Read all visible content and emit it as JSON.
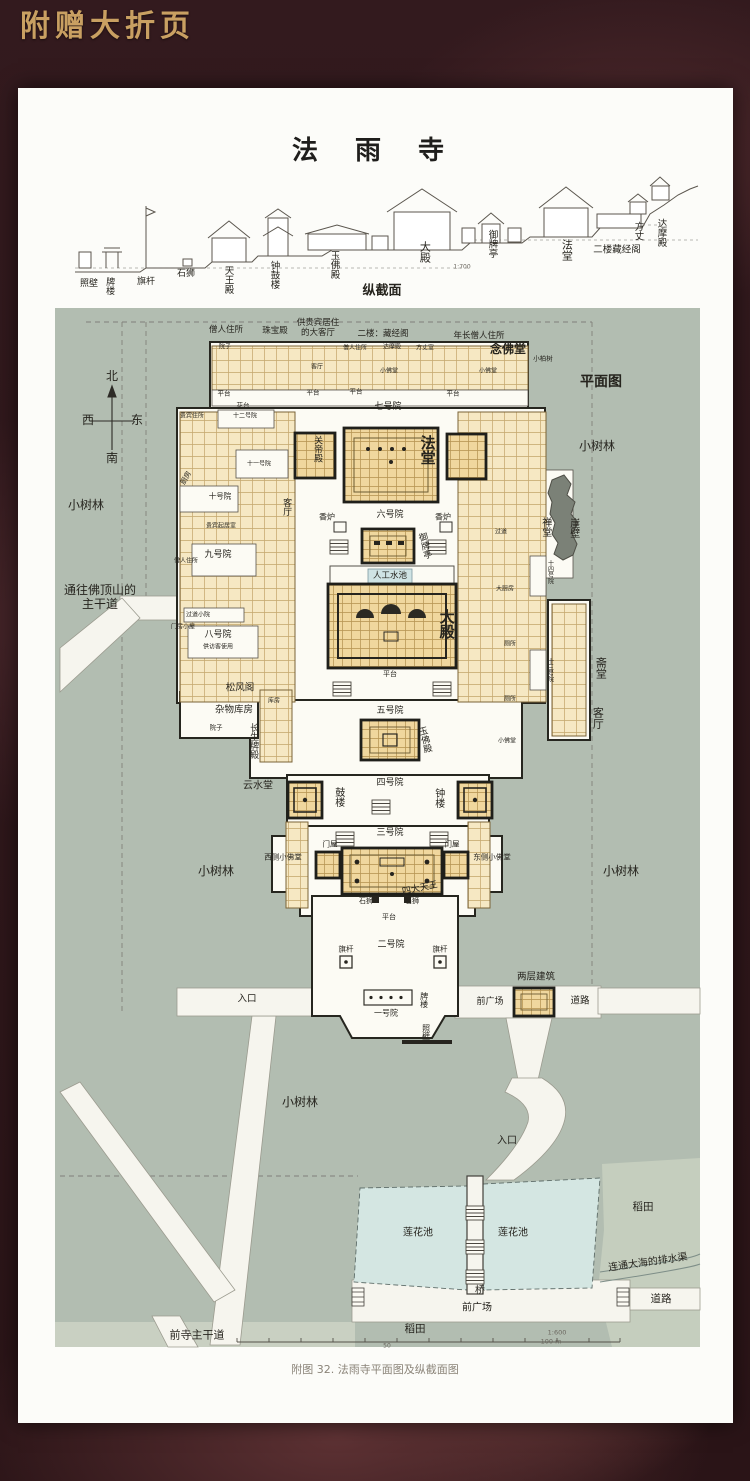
{
  "page": {
    "foldout_title": "附赠大折页",
    "temple_title": "法 雨 寺",
    "caption": "附图 32. 法雨寺平面图及纵截面图"
  },
  "section": {
    "labels": [
      {
        "t": "照壁",
        "x": 89,
        "y": 284,
        "s": 9
      },
      {
        "t": "牌楼",
        "x": 109,
        "y": 286,
        "o": "v",
        "s": 9
      },
      {
        "t": "旗杆",
        "x": 146,
        "y": 282,
        "s": 9
      },
      {
        "t": "石狮",
        "x": 186,
        "y": 274,
        "s": 9
      },
      {
        "t": "天王殿",
        "x": 227,
        "y": 280,
        "o": "v",
        "s": 9.5
      },
      {
        "t": "钟鼓楼",
        "x": 273,
        "y": 275,
        "o": "v",
        "s": 9.5
      },
      {
        "t": "玉佛殿",
        "x": 333,
        "y": 265,
        "o": "v",
        "s": 9.5
      },
      {
        "t": "大殿",
        "x": 424,
        "y": 252,
        "o": "v",
        "s": 11
      },
      {
        "t": "御牌亭",
        "x": 491,
        "y": 244,
        "o": "v",
        "s": 9.5
      },
      {
        "t": "法堂",
        "x": 566,
        "y": 250,
        "o": "v",
        "s": 11
      },
      {
        "t": "二楼藏经阁",
        "x": 617,
        "y": 251,
        "s": 9.5
      },
      {
        "t": "方丈",
        "x": 637,
        "y": 231,
        "o": "v",
        "s": 9.5
      },
      {
        "t": "达摩殿",
        "x": 660,
        "y": 233,
        "o": "v",
        "s": 9.5
      },
      {
        "t": "纵截面",
        "x": 382,
        "y": 292,
        "s": 13,
        "b": 1
      },
      {
        "t": "1:700",
        "x": 462,
        "y": 268,
        "s": 6,
        "c": "#6b675f"
      }
    ]
  },
  "plan": {
    "labels": [
      {
        "t": "平面图",
        "x": 601,
        "y": 382,
        "s": 14,
        "b": 1
      },
      {
        "t": "北",
        "x": 112,
        "y": 377,
        "s": 12
      },
      {
        "t": "西",
        "x": 88,
        "y": 421,
        "s": 12
      },
      {
        "t": "东",
        "x": 137,
        "y": 421,
        "s": 12
      },
      {
        "t": "南",
        "x": 112,
        "y": 459,
        "s": 12
      },
      {
        "t": "小树林",
        "x": 86,
        "y": 506,
        "s": 12
      },
      {
        "t": "小树林",
        "x": 597,
        "y": 447,
        "s": 12
      },
      {
        "t": "小树林",
        "x": 216,
        "y": 872,
        "s": 12
      },
      {
        "t": "小树林",
        "x": 621,
        "y": 872,
        "s": 12
      },
      {
        "t": "小树林",
        "x": 300,
        "y": 1103,
        "s": 12
      },
      {
        "t": "通往佛顶山的\n主干道",
        "x": 100,
        "y": 598,
        "s": 12
      },
      {
        "t": "僧人住所",
        "x": 226,
        "y": 331,
        "s": 8.5
      },
      {
        "t": "珠宝殿",
        "x": 275,
        "y": 332,
        "s": 8.5
      },
      {
        "t": "供贵宾居住\n的大客厅",
        "x": 318,
        "y": 329,
        "s": 8.5
      },
      {
        "t": "二楼：藏经阁",
        "x": 383,
        "y": 335,
        "s": 8.5
      },
      {
        "t": "年长僧人住所",
        "x": 479,
        "y": 337,
        "s": 8.5
      },
      {
        "t": "念佛堂",
        "x": 508,
        "y": 350,
        "s": 12,
        "b": 1
      },
      {
        "t": "小柏树",
        "x": 543,
        "y": 359,
        "s": 6.5
      },
      {
        "t": "院子",
        "x": 225,
        "y": 348,
        "s": 6
      },
      {
        "t": "客厅",
        "x": 317,
        "y": 368,
        "s": 6
      },
      {
        "t": "僧人住所",
        "x": 355,
        "y": 349,
        "s": 6
      },
      {
        "t": "达摩殿",
        "x": 392,
        "y": 348,
        "s": 6
      },
      {
        "t": "方丈室",
        "x": 425,
        "y": 349,
        "s": 6
      },
      {
        "t": "小佛堂",
        "x": 389,
        "y": 372,
        "s": 6
      },
      {
        "t": "小佛堂",
        "x": 488,
        "y": 372,
        "s": 6
      },
      {
        "t": "平台",
        "x": 224,
        "y": 394,
        "s": 6.5
      },
      {
        "t": "平台",
        "x": 313,
        "y": 393,
        "s": 6.5
      },
      {
        "t": "平台",
        "x": 356,
        "y": 392,
        "s": 6.5
      },
      {
        "t": "平台",
        "x": 453,
        "y": 394,
        "s": 6.5
      },
      {
        "t": "花台",
        "x": 243,
        "y": 406,
        "s": 6.5
      },
      {
        "t": "七号院",
        "x": 388,
        "y": 407,
        "s": 9
      },
      {
        "t": "贵宾住所",
        "x": 192,
        "y": 417,
        "s": 6
      },
      {
        "t": "十二号院",
        "x": 245,
        "y": 417,
        "s": 6
      },
      {
        "t": "十一号院",
        "x": 259,
        "y": 465,
        "s": 6
      },
      {
        "t": "十号院",
        "x": 220,
        "y": 497,
        "s": 7.5
      },
      {
        "t": "贵宾起居室",
        "x": 221,
        "y": 527,
        "s": 6
      },
      {
        "t": "厨房",
        "x": 186,
        "y": 478,
        "s": 7,
        "r": -60
      },
      {
        "t": "关帝殿",
        "x": 317,
        "y": 449,
        "o": "v",
        "s": 9
      },
      {
        "t": "法堂",
        "x": 427,
        "y": 450,
        "o": "v",
        "s": 15,
        "b": 1
      },
      {
        "t": "客厅",
        "x": 286,
        "y": 507,
        "o": "v",
        "s": 9
      },
      {
        "t": "香炉",
        "x": 327,
        "y": 517,
        "s": 8
      },
      {
        "t": "六号院",
        "x": 390,
        "y": 515,
        "s": 9
      },
      {
        "t": "香炉",
        "x": 443,
        "y": 517,
        "s": 8
      },
      {
        "t": "御牌亭",
        "x": 424,
        "y": 546,
        "o": "v",
        "s": 9,
        "r": -14
      },
      {
        "t": "人工水池",
        "x": 390,
        "y": 577,
        "s": 8.5
      },
      {
        "t": "大殿",
        "x": 446,
        "y": 624,
        "o": "v",
        "s": 15,
        "b": 1
      },
      {
        "t": "过道",
        "x": 501,
        "y": 533,
        "s": 6
      },
      {
        "t": "大厨房",
        "x": 505,
        "y": 590,
        "s": 6
      },
      {
        "t": "厕所",
        "x": 510,
        "y": 645,
        "s": 6
      },
      {
        "t": "厕所",
        "x": 510,
        "y": 700,
        "s": 6
      },
      {
        "t": "小佛堂",
        "x": 507,
        "y": 742,
        "s": 6
      },
      {
        "t": "禅堂",
        "x": 545,
        "y": 527,
        "o": "v",
        "s": 10
      },
      {
        "t": "崖壁",
        "x": 573,
        "y": 528,
        "o": "v",
        "s": 10
      },
      {
        "t": "十四号院",
        "x": 549,
        "y": 572,
        "o": "v",
        "s": 6
      },
      {
        "t": "十三号院",
        "x": 549,
        "y": 670,
        "o": "v",
        "s": 6
      },
      {
        "t": "斋堂",
        "x": 600,
        "y": 668,
        "o": "v",
        "s": 11
      },
      {
        "t": "客厅",
        "x": 597,
        "y": 718,
        "o": "v",
        "s": 11
      },
      {
        "t": "九号院",
        "x": 218,
        "y": 555,
        "s": 9
      },
      {
        "t": "僧人住所",
        "x": 186,
        "y": 562,
        "s": 6
      },
      {
        "t": "过道小院",
        "x": 198,
        "y": 616,
        "s": 6
      },
      {
        "t": "门房小屋",
        "x": 183,
        "y": 628,
        "s": 6
      },
      {
        "t": "八号院",
        "x": 218,
        "y": 635,
        "s": 9
      },
      {
        "t": "供访客使用",
        "x": 218,
        "y": 648,
        "s": 6
      },
      {
        "t": "松风阁",
        "x": 240,
        "y": 689,
        "s": 9.5
      },
      {
        "t": "杂物库房",
        "x": 234,
        "y": 711,
        "s": 9.5
      },
      {
        "t": "院子",
        "x": 216,
        "y": 728,
        "s": 6.5
      },
      {
        "t": "长生牌殿",
        "x": 253,
        "y": 741,
        "o": "v",
        "s": 9
      },
      {
        "t": "库房",
        "x": 274,
        "y": 702,
        "s": 6
      },
      {
        "t": "云水堂",
        "x": 258,
        "y": 786,
        "s": 10
      },
      {
        "t": "平台",
        "x": 390,
        "y": 674,
        "s": 7
      },
      {
        "t": "五号院",
        "x": 390,
        "y": 711,
        "s": 9
      },
      {
        "t": "玉佛殿",
        "x": 424,
        "y": 740,
        "o": "v",
        "s": 9,
        "r": -14
      },
      {
        "t": "四号院",
        "x": 390,
        "y": 783,
        "s": 9
      },
      {
        "t": "鼓楼",
        "x": 338,
        "y": 797,
        "o": "v",
        "s": 10
      },
      {
        "t": "钟楼",
        "x": 438,
        "y": 798,
        "o": "v",
        "s": 10
      },
      {
        "t": "三号院",
        "x": 390,
        "y": 833,
        "s": 9
      },
      {
        "t": "门屋",
        "x": 330,
        "y": 845,
        "s": 7.5
      },
      {
        "t": "门屋",
        "x": 452,
        "y": 845,
        "s": 7.5
      },
      {
        "t": "西侧小佛堂",
        "x": 283,
        "y": 858,
        "s": 7.5
      },
      {
        "t": "东侧小佛堂",
        "x": 492,
        "y": 858,
        "s": 7.5
      },
      {
        "t": "四大天王",
        "x": 420,
        "y": 889,
        "s": 9,
        "r": -12
      },
      {
        "t": "石狮",
        "x": 366,
        "y": 901,
        "s": 7
      },
      {
        "t": "石狮",
        "x": 412,
        "y": 901,
        "s": 7
      },
      {
        "t": "平台",
        "x": 389,
        "y": 917,
        "s": 7
      },
      {
        "t": "二号院",
        "x": 391,
        "y": 945,
        "s": 9
      },
      {
        "t": "旗杆",
        "x": 346,
        "y": 950,
        "s": 7.5
      },
      {
        "t": "旗杆",
        "x": 440,
        "y": 950,
        "s": 7.5
      },
      {
        "t": "入口",
        "x": 247,
        "y": 1000,
        "s": 9.5
      },
      {
        "t": "一号院",
        "x": 386,
        "y": 1013,
        "s": 8
      },
      {
        "t": "牌楼",
        "x": 424,
        "y": 1000,
        "o": "v",
        "s": 8
      },
      {
        "t": "照壁",
        "x": 426,
        "y": 1032,
        "o": "v",
        "s": 8
      },
      {
        "t": "前广场",
        "x": 490,
        "y": 1002,
        "s": 9
      },
      {
        "t": "两层建筑",
        "x": 536,
        "y": 978,
        "s": 9.5
      },
      {
        "t": "道路",
        "x": 580,
        "y": 1002,
        "s": 9.5
      },
      {
        "t": "入口",
        "x": 507,
        "y": 1141,
        "s": 10
      },
      {
        "t": "莲花池",
        "x": 418,
        "y": 1233,
        "s": 10
      },
      {
        "t": "莲花池",
        "x": 513,
        "y": 1233,
        "s": 10
      },
      {
        "t": "稻田",
        "x": 643,
        "y": 1207,
        "s": 10.5
      },
      {
        "t": "连通大海的排水渠",
        "x": 648,
        "y": 1263,
        "s": 10,
        "r": -8
      },
      {
        "t": "桥",
        "x": 480,
        "y": 1291,
        "s": 10
      },
      {
        "t": "前广场",
        "x": 477,
        "y": 1308,
        "s": 10
      },
      {
        "t": "道路",
        "x": 661,
        "y": 1299,
        "s": 10.5
      },
      {
        "t": "稻田",
        "x": 415,
        "y": 1329,
        "s": 10.5
      },
      {
        "t": "前寺主干道",
        "x": 197,
        "y": 1336,
        "s": 11
      },
      {
        "t": "1:600",
        "x": 557,
        "y": 1333,
        "s": 6.5,
        "c": "#6b675f"
      },
      {
        "t": "100 m",
        "x": 551,
        "y": 1342,
        "s": 6.5,
        "c": "#6b675f"
      },
      {
        "t": "50",
        "x": 387,
        "y": 1347,
        "s": 6,
        "c": "#6b675f"
      }
    ]
  }
}
